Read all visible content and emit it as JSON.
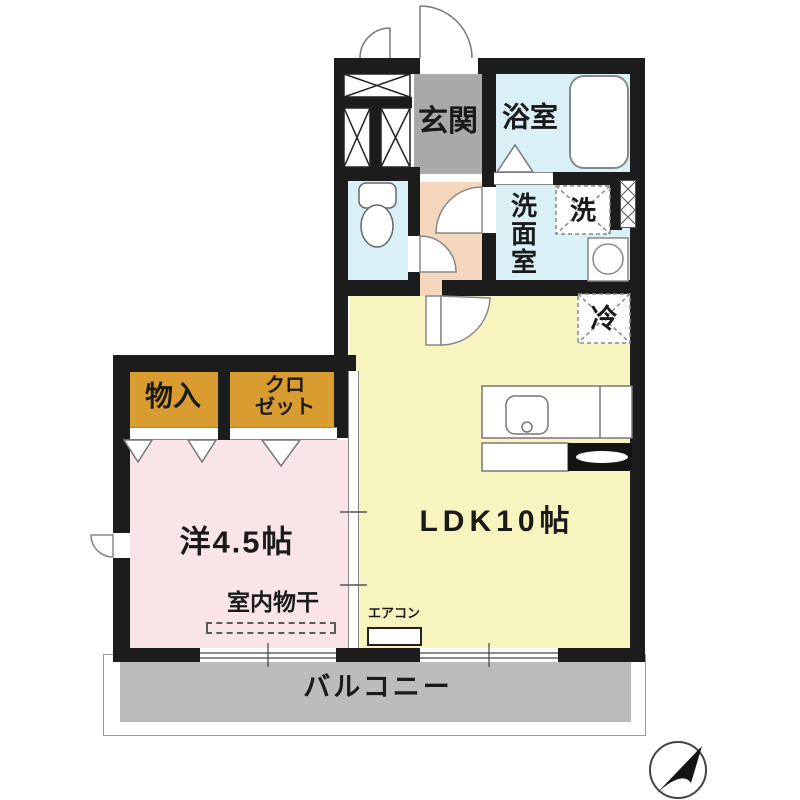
{
  "floor_plan": {
    "labels": {
      "genkan": "玄関",
      "bathroom": "浴室",
      "washroom": "洗面室",
      "washer": "洗",
      "fridge": "冷",
      "storage": "物入",
      "closet_line1": "クロ",
      "closet_line2": "ゼット",
      "western_room": "洋4.5帖",
      "ldk": "LDK10帖",
      "indoor_drying": "室内物干",
      "aircon": "エアコン",
      "balcony": "バルコニー"
    },
    "colors": {
      "wall": "#1c1c1c",
      "ldk_fill": "#f8f4c0",
      "bedroom_fill": "#f9e5e8",
      "wet_area_fill": "#d9f0f7",
      "hall_fill": "#f4d7bd",
      "genkan_fill": "#a9a9a9",
      "balcony_fill": "#bcbcbc",
      "closet_fill": "#d99c30"
    },
    "compass_icon": "north-arrow"
  }
}
